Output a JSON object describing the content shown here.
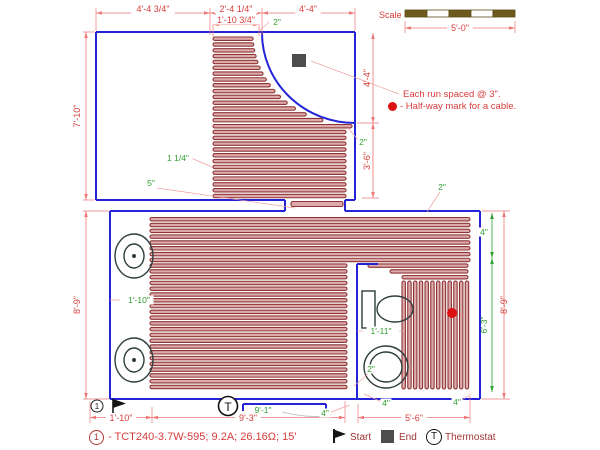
{
  "scale": {
    "label": "Scale",
    "dimension": "5'-0\""
  },
  "notes": {
    "spacing_note": "Each run spaced @ 3\".",
    "halfway_note": "- Half-way mark for a cable."
  },
  "legend": {
    "circuit_number": "1",
    "circuit_spec": "- TCT240-3.7W-595; 9.2A; 26.16Ω; 15'",
    "start_label": "Start",
    "end_label": "End",
    "thermostat_label": "Thermostat"
  },
  "plan": {
    "circuit_marker": "1",
    "thermostat_symbol": "T"
  },
  "annotations": {
    "red_dimensions": [
      {
        "text": "4'-4 3/4\"",
        "x": 153,
        "y": 12
      },
      {
        "text": "2'-4 1/4\"",
        "x": 236,
        "y": 12
      },
      {
        "text": "4'-4\"",
        "x": 308,
        "y": 12
      },
      {
        "text": "1'-10 3/4\"",
        "x": 236,
        "y": 23
      },
      {
        "text": "7'-10\"",
        "x": 80,
        "y": 116,
        "rot": -90
      },
      {
        "text": "4'-4\"",
        "x": 370,
        "y": 78,
        "rot": -90
      },
      {
        "text": "3'-6\"",
        "x": 370,
        "y": 161,
        "rot": -90
      },
      {
        "text": "8'-9\"",
        "x": 80,
        "y": 305,
        "rot": -90
      },
      {
        "text": "8'-9\"",
        "x": 507,
        "y": 305,
        "rot": -90
      },
      {
        "text": "1'-10\"",
        "x": 121,
        "y": 421
      },
      {
        "text": "9'-3\"",
        "x": 248,
        "y": 421
      },
      {
        "text": "5'-6\"",
        "x": 414,
        "y": 421
      },
      {
        "text": "5'-0\"",
        "x": 460,
        "y": 31
      }
    ],
    "green_labels": [
      {
        "text": "2\"",
        "x": 277,
        "y": 25,
        "leader": [
          269,
          22,
          259,
          31
        ]
      },
      {
        "text": "1 1/4\"",
        "x": 178,
        "y": 161,
        "leader": [
          191,
          158,
          212,
          167
        ]
      },
      {
        "text": "5\"",
        "x": 151,
        "y": 186,
        "leader": [
          157,
          188,
          295,
          208
        ]
      },
      {
        "text": "2\"",
        "x": 363,
        "y": 145,
        "leader": [
          359,
          141,
          348,
          128
        ]
      },
      {
        "text": "2\"",
        "x": 442,
        "y": 190,
        "leader": [
          440,
          192,
          427,
          212
        ]
      },
      {
        "text": "4\"",
        "x": 484,
        "y": 235
      },
      {
        "text": "1'-10\"",
        "x": 139,
        "y": 303,
        "leader": [
          110,
          300,
          120,
          300
        ],
        "leader2": [
          158,
          300,
          166,
          300
        ]
      },
      {
        "text": "1'-11\"",
        "x": 381,
        "y": 334,
        "leader": [
          357,
          331,
          363,
          331
        ],
        "leader2": [
          399,
          331,
          405,
          331
        ]
      },
      {
        "text": "2\"",
        "x": 371,
        "y": 372,
        "leader": [
          368,
          374,
          354,
          386
        ]
      },
      {
        "text": "6'-3\"",
        "x": 487,
        "y": 325,
        "rot": -90
      },
      {
        "text": "9'-1\"",
        "x": 263,
        "y": 413
      },
      {
        "text": "4\"",
        "x": 325,
        "y": 416,
        "leader": [
          331,
          412,
          350,
          405
        ]
      },
      {
        "text": "4\"",
        "x": 386,
        "y": 406,
        "leader": [
          382,
          402,
          364,
          394
        ]
      },
      {
        "text": "4\"",
        "x": 457,
        "y": 405,
        "leader": [
          462,
          400,
          471,
          394
        ]
      }
    ]
  },
  "colors": {
    "wall": "#2424d6",
    "cable_stroke": "#8e3434",
    "cable_fill": "#dcaaaa",
    "dim_line": "#ee7777",
    "dim_text": "#d83c3c",
    "green": "#2fa02f",
    "marker_red": "#dd1111",
    "dark": "#4d4d4d",
    "fixture": "#2e3d3d",
    "scale_bar": "#6e5a1c"
  }
}
